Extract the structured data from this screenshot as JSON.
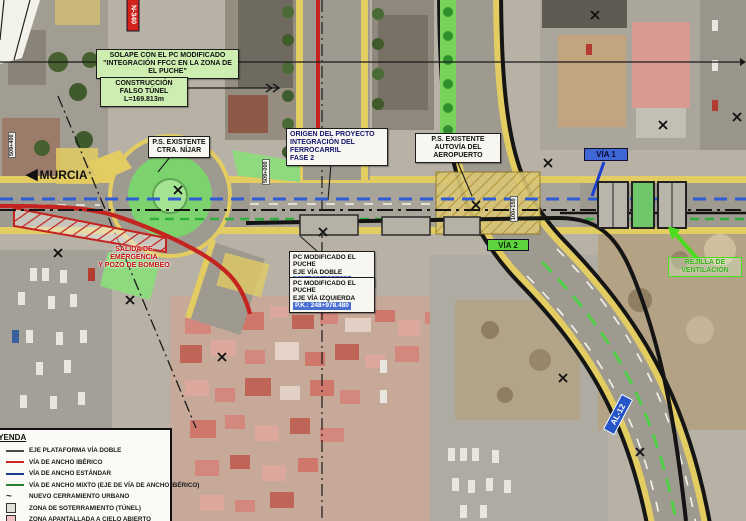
{
  "annotations": {
    "solape_box": {
      "line1": "SOLAPE CON EL PC MODIFICADO",
      "line2": "\"INTEGRACIÓN FFCC EN LA ZONA DE EL PUCHE\""
    },
    "falso_tunel": {
      "line1": "CONSTRUCCIÓN FALSO TÚNEL",
      "line2": "L=169.813m"
    },
    "ps_nijar": {
      "line1": "P.S. EXISTENTE",
      "line2": "CTRA. NÍJAR"
    },
    "origen": {
      "line1": "ORIGEN DEL PROYECTO",
      "line2": "INTEGRACIÓN DEL FERROCARRIL",
      "line3": "FASE 2"
    },
    "ps_aeropuerto": {
      "line1": "P.S. EXISTENTE",
      "line2": "AUTOVÍA DEL AEROPUERTO"
    },
    "murcia": "MURCIA",
    "salida": {
      "line1": "SALIDA DE EMERGENCIA",
      "line2": "Y POZO DE BOMBEO"
    },
    "pc_via_doble": {
      "line1": "PC MODIFICADO EL PUCHE",
      "line2": "EJE VÍA DOBLE",
      "line3": "P.K.: 509+224.366"
    },
    "pc_via_izq": {
      "line1": "PC MODIFICADO EL PUCHE",
      "line2": "EJE VÍA IZQUIERDA",
      "line3": "P.K.: 248+978.480"
    },
    "via1_badge": "VÍA 1",
    "via2_badge": "VÍA 2",
    "rejilla": "REJILLA DE VENTILACIÓN",
    "al12_badge": "AL-12",
    "n340_badge": "N-340",
    "pk_marker_left": "509+400",
    "pk_marker_center": "509+000",
    "pk_marker_right": "100+150"
  },
  "legend": {
    "title": "LEYENDA",
    "items": [
      {
        "label": "EJE PLATAFORMA VÍA DOBLE",
        "swatch": "line",
        "color": "#4a4a4a"
      },
      {
        "label": "VÍA DE ANCHO IBÉRICO",
        "swatch": "line",
        "color": "#c62828"
      },
      {
        "label": "VÍA DE ANCHO ESTÁNDAR",
        "swatch": "line",
        "color": "#1a3a8c"
      },
      {
        "label": "VÍA DE ANCHO MIXTO (EJE DE VÍA DE ANCHO IBÉRICO)",
        "swatch": "line",
        "color": "#2e7d32"
      },
      {
        "label": "NUEVO CERRAMIENTO URBANO",
        "swatch": "wave",
        "color": "#222222"
      },
      {
        "label": "ZONA DE SOTERRAMIENTO (TÚNEL)",
        "swatch": "box",
        "color": "#e2e1d8"
      },
      {
        "label": "ZONA APANTALLADA A CIELO ABIERTO",
        "swatch": "box",
        "color": "#f2c4c4"
      }
    ]
  },
  "colors": {
    "corridor_yellow": "#e3cc62",
    "iberico_red": "#c4231f",
    "estandar_blue": "#2f5bd6",
    "mixto_green": "#2fae3c",
    "label_green_bg": "#cdeeb0"
  }
}
